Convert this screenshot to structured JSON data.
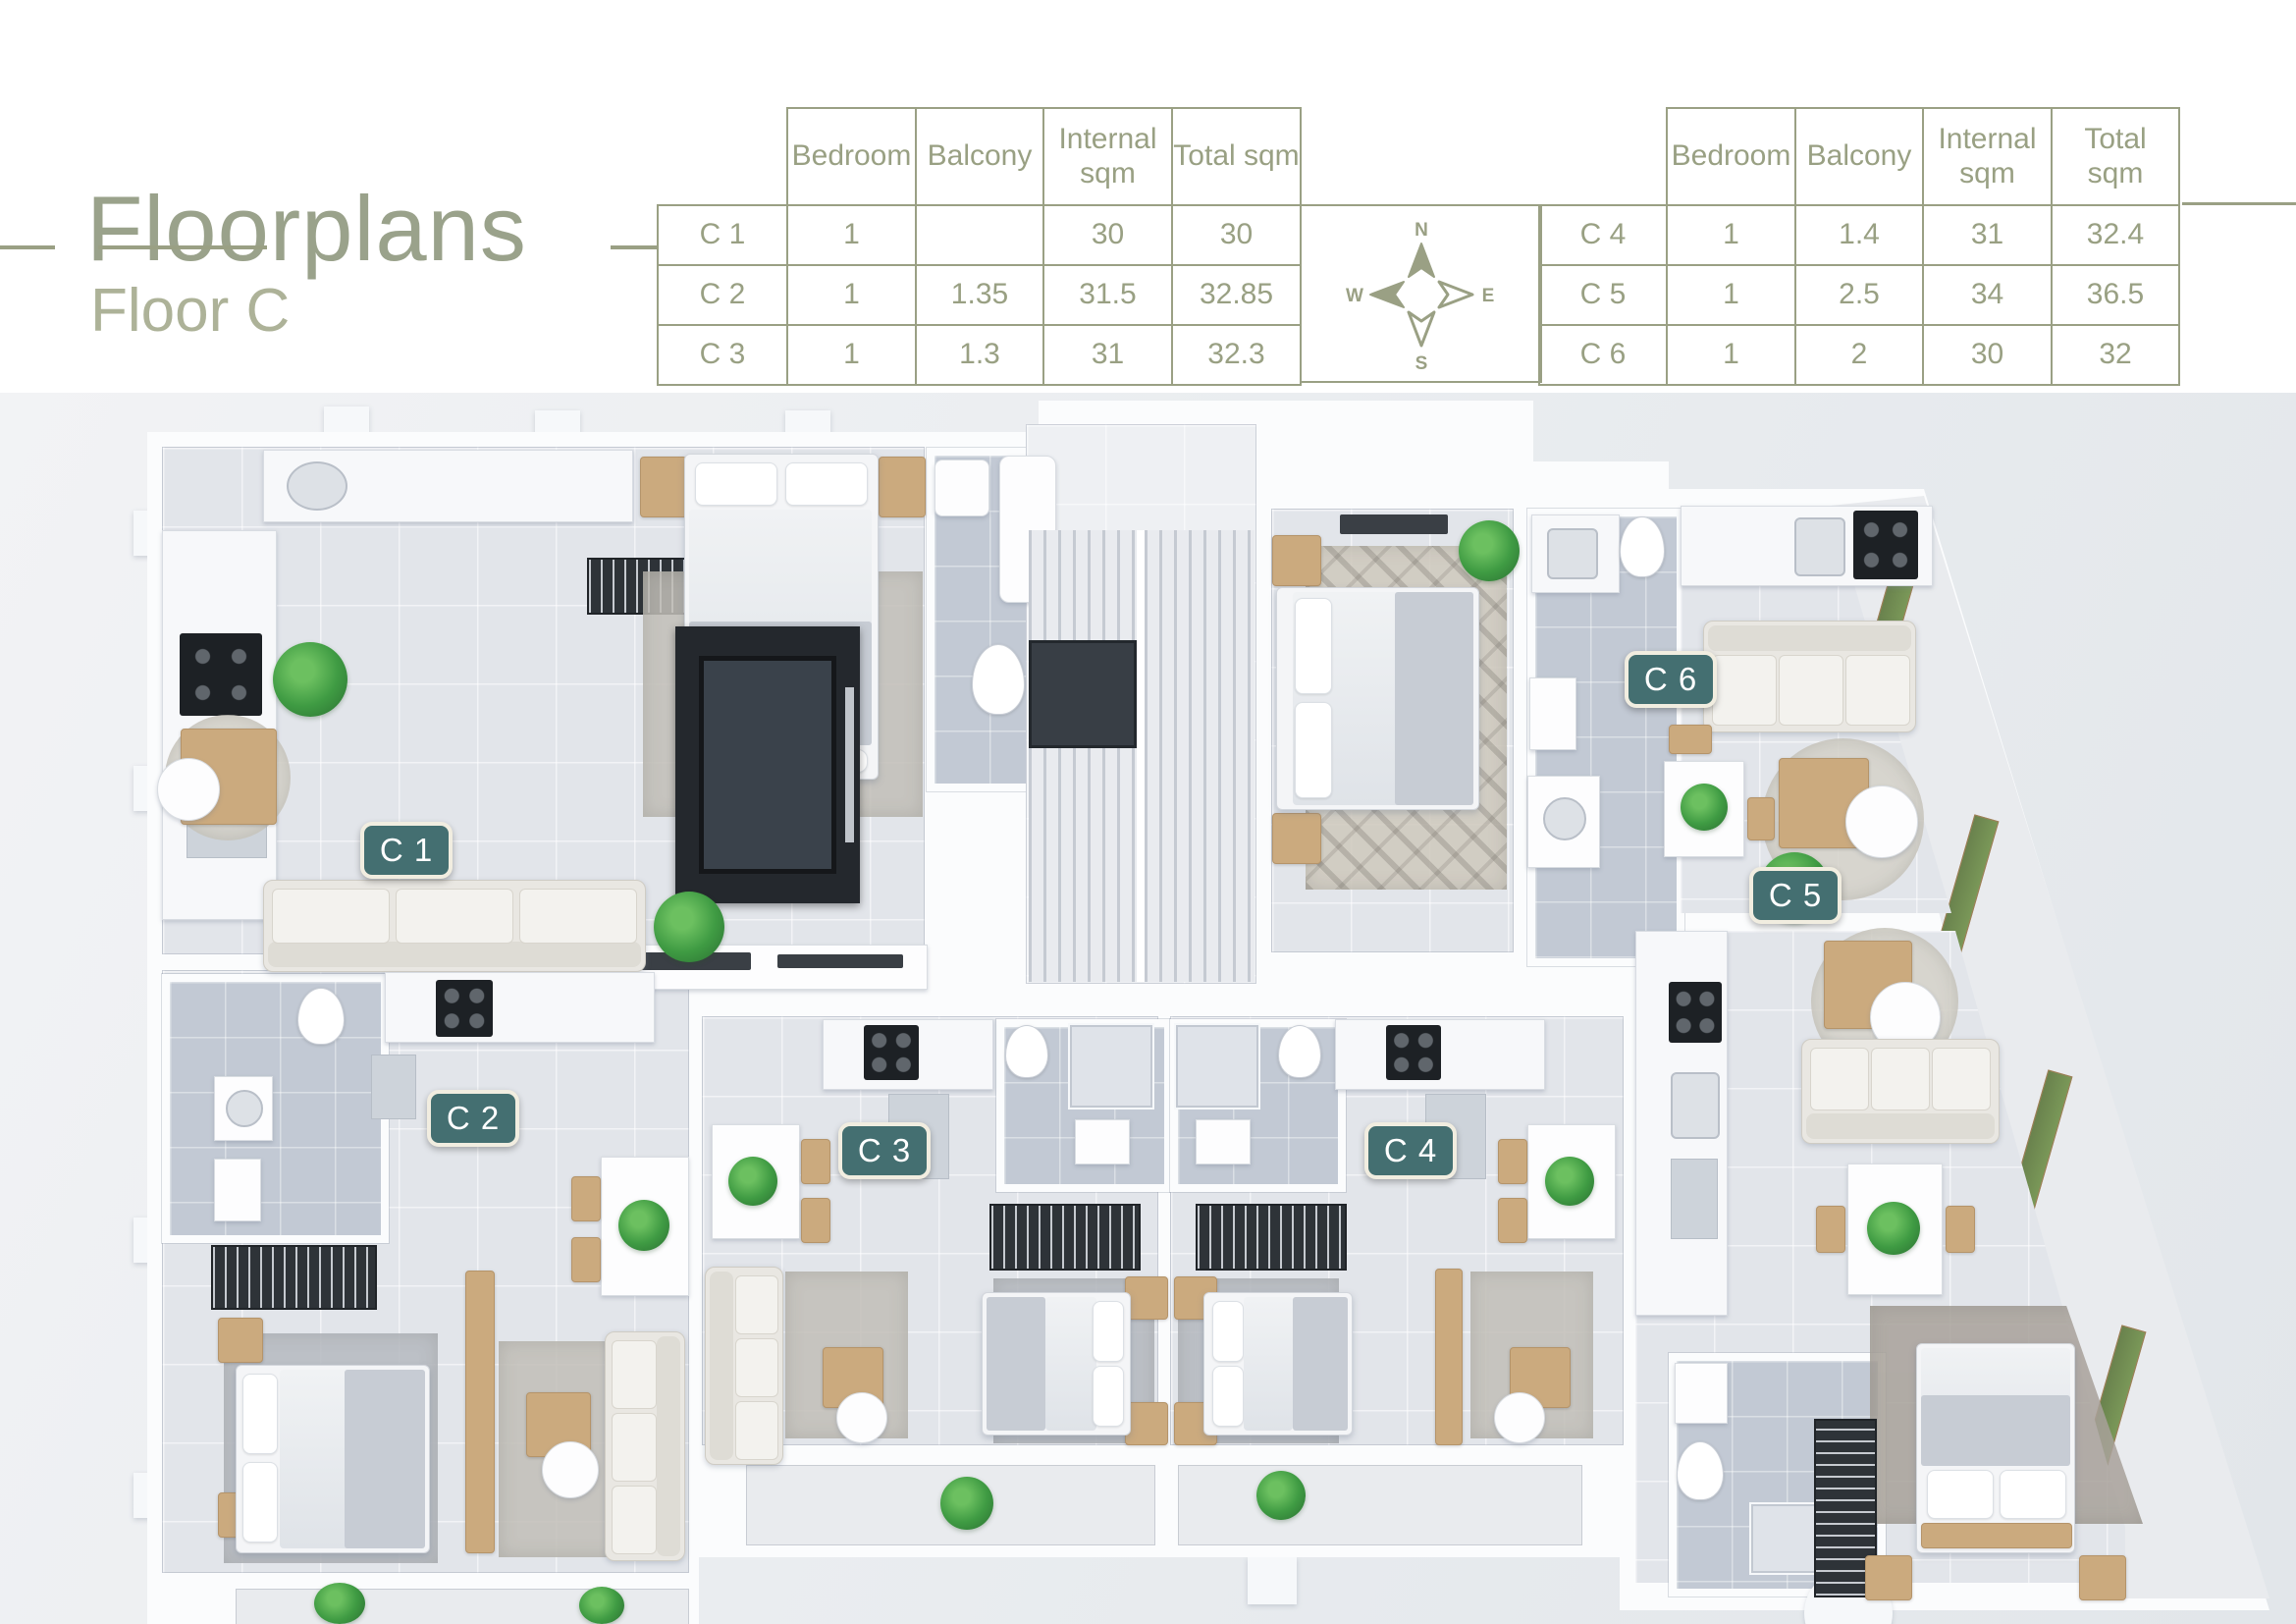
{
  "page": {
    "title": "Floorplans",
    "subtitle": "Floor C"
  },
  "tables": {
    "headers": [
      "Bedroom",
      "Balcony",
      "Internal sqm",
      "Total sqm"
    ],
    "left": {
      "rows": [
        {
          "unit": "C 1",
          "bedroom": "1",
          "balcony": "",
          "internal": "30",
          "total": "30"
        },
        {
          "unit": "C 2",
          "bedroom": "1",
          "balcony": "1.35",
          "internal": "31.5",
          "total": "32.85"
        },
        {
          "unit": "C 3",
          "bedroom": "1",
          "balcony": "1.3",
          "internal": "31",
          "total": "32.3"
        }
      ]
    },
    "right": {
      "rows": [
        {
          "unit": "C 4",
          "bedroom": "1",
          "balcony": "1.4",
          "internal": "31",
          "total": "32.4"
        },
        {
          "unit": "C 5",
          "bedroom": "1",
          "balcony": "2.5",
          "internal": "34",
          "total": "36.5"
        },
        {
          "unit": "C 6",
          "bedroom": "1",
          "balcony": "2",
          "internal": "30",
          "total": "32"
        }
      ]
    }
  },
  "compass": {
    "north": "N",
    "east": "E",
    "south": "S",
    "west": "W"
  },
  "floorplan": {
    "unit_labels": [
      {
        "id": "c1",
        "text": "C 1"
      },
      {
        "id": "c2",
        "text": "C 2"
      },
      {
        "id": "c3",
        "text": "C 3"
      },
      {
        "id": "c4",
        "text": "C 4"
      },
      {
        "id": "c5",
        "text": "C 5"
      },
      {
        "id": "c6",
        "text": "C 6"
      }
    ]
  },
  "colors": {
    "accent_olive": "#9aa084",
    "label_teal": "#446f71",
    "floor_light": "#e2e5ea",
    "bath_floor": "#c2c9d4",
    "dark_core": "#24282d",
    "plant_green": "#3f9b43",
    "wood": "#cbaa7e"
  }
}
